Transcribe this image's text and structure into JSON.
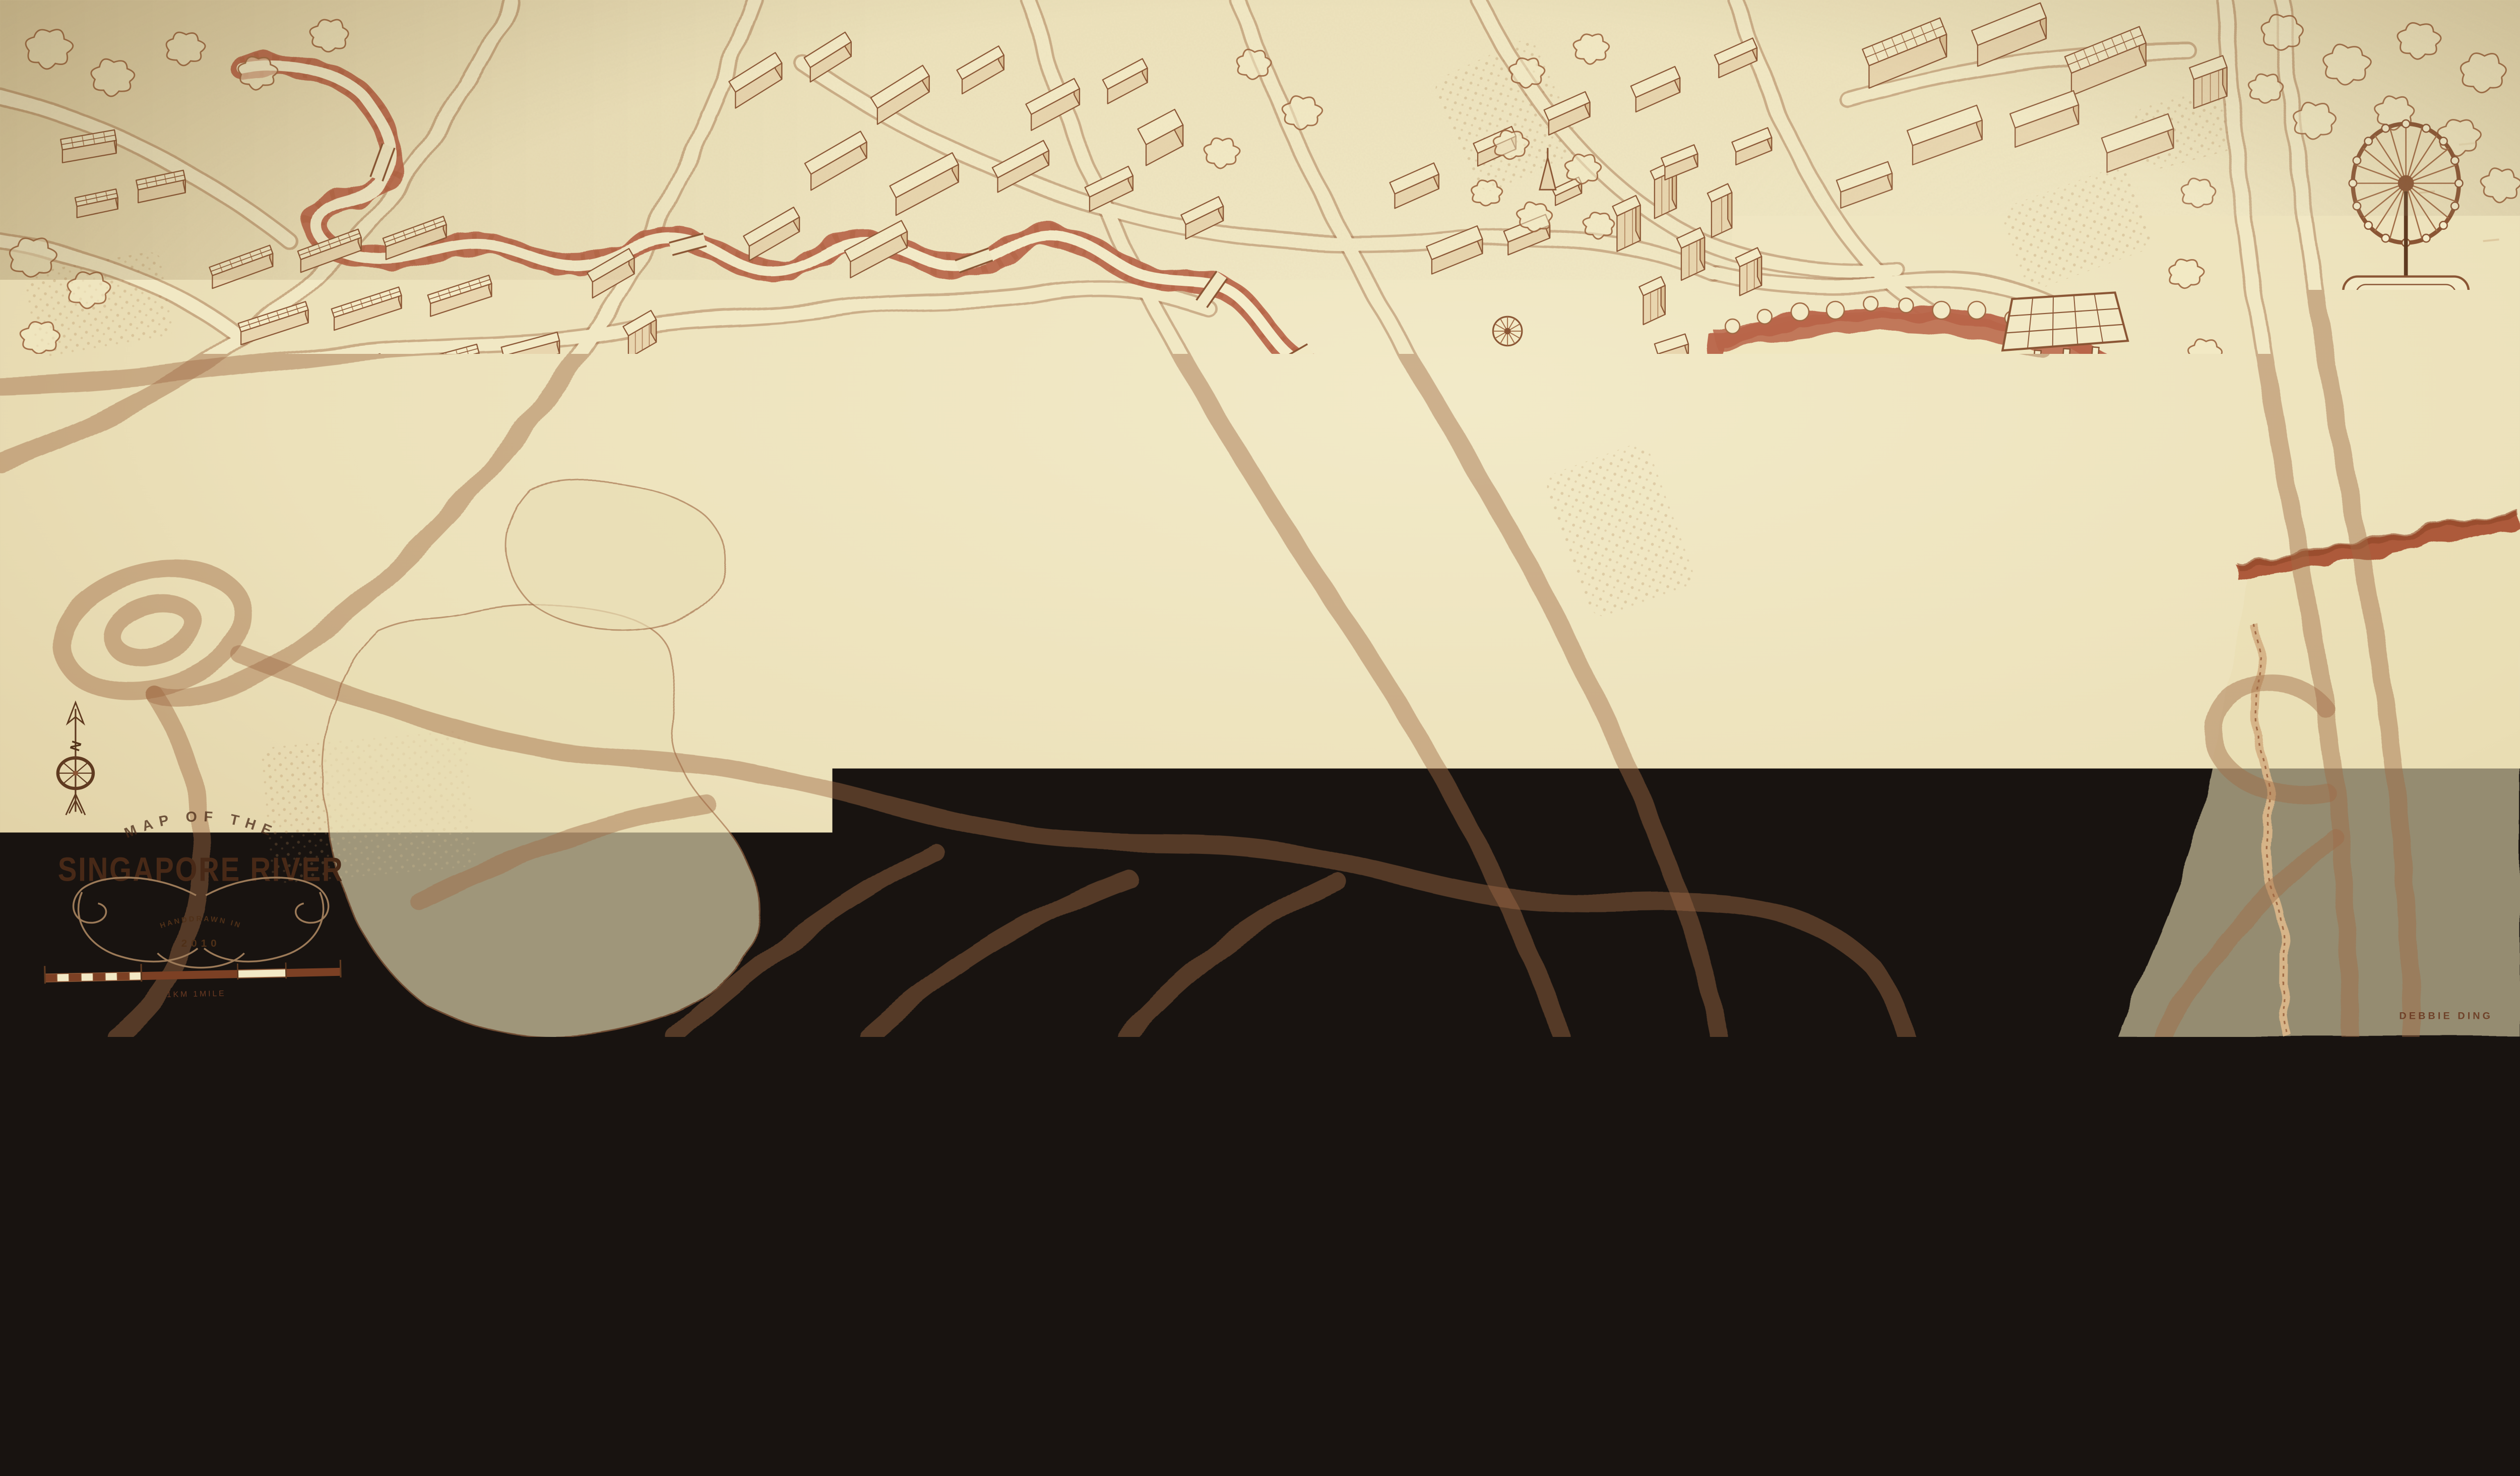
{
  "artwork": {
    "title_upper": "MAP OF THE",
    "title_main": "SINGAPORE RIVER",
    "badge_line1": "HANDDRAWN IN",
    "badge_line2": "2010",
    "compass_label": "N",
    "scale_label": "1KM 1MILE",
    "signature": "DEBBIE DING"
  },
  "palette": {
    "paper": "#ece1ba",
    "paper_light": "#f4ecca",
    "road": "#f1e8c4",
    "ink": "#8a5534",
    "ink_light": "#a06b45",
    "ink_dark": "#5f3a20",
    "bank": "#b96548",
    "bank_dark": "#a4512f",
    "shade_front": "#e8d5ae",
    "shade_side": "#dbc094",
    "block_top": "#f3eac6",
    "title_ink": "#482917"
  },
  "icons": [
    "compass-rose-icon",
    "scale-bar",
    "ferris-wheel-icon",
    "grandstand-icon",
    "floating-platform-icon",
    "ship-icon",
    "spiky-domes-icon",
    "dome-rotunda-icon",
    "church-spire-icon",
    "statue-icon",
    "river",
    "marina-bay",
    "tree-canopy"
  ]
}
